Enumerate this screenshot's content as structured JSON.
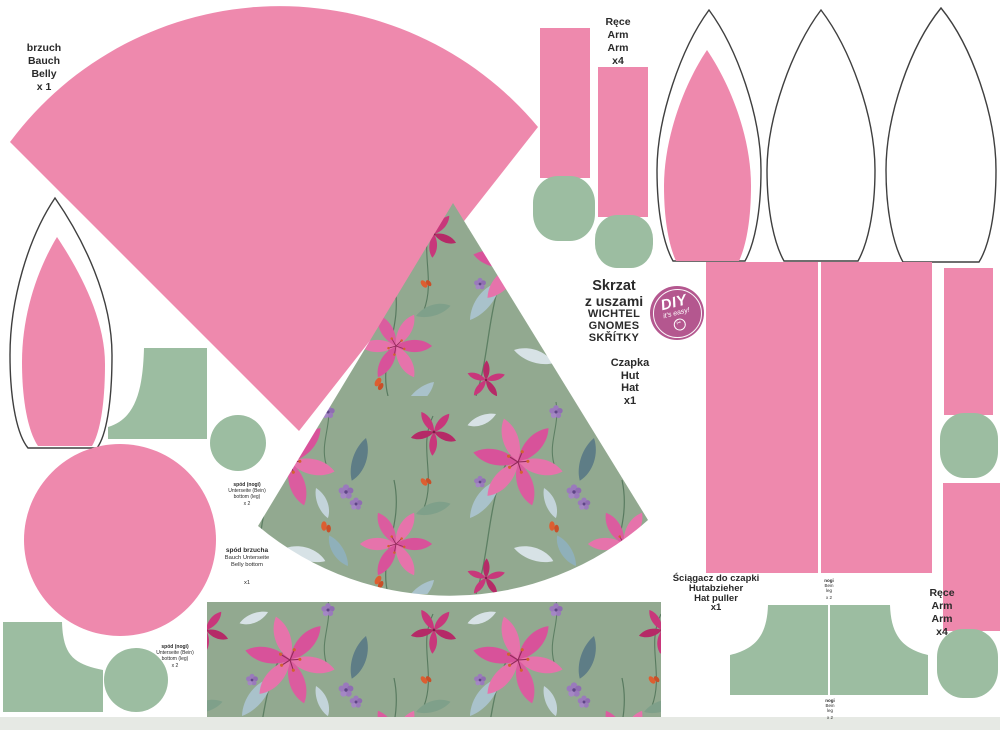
{
  "colors": {
    "pink": "#ee89ad",
    "sage": "#9cbda1",
    "fabric": "#92a990",
    "badge": "#b4578f",
    "outline": "#3f3f3f",
    "text": "#2a2a2a",
    "band": "#e6e9e4"
  },
  "badge": {
    "title": "DIY",
    "subtitle": "it's easy!",
    "icon": "scissors"
  },
  "labels": {
    "belly": [
      "brzuch",
      "Bauch",
      "Belly",
      "x 1"
    ],
    "arms_top": [
      "Ręce",
      "Arm",
      "Arm",
      "x4"
    ],
    "title": [
      "Skrzat",
      "z uszami",
      "WICHTEL",
      "GNOMES",
      "SKŘÍTKY"
    ],
    "hat": [
      "Czapka",
      "Hut",
      "Hat",
      "x1"
    ],
    "leg_bottom_small_1": [
      "spód (nogi)",
      "Unterseite (Bein)",
      "bottom (leg)",
      "x 2"
    ],
    "belly_bottom": [
      "spód brzucha",
      "Bauch Unterseite",
      "Belly bottom",
      "x1"
    ],
    "leg_bottom_small_2": [
      "spód (nogi)",
      "Unterseite (Bein)",
      "bottom (leg)",
      "x 2"
    ],
    "hat_puller": [
      "Ściągacz do czapki",
      "Hutabzieher",
      "Hat puller",
      "x1"
    ],
    "arms_right": [
      "Ręce",
      "Arm",
      "Arm",
      "x4"
    ],
    "legs_top": [
      "nogi",
      "Bein",
      "leg",
      "x 2"
    ],
    "legs_bottom": [
      "nogi",
      "Bein",
      "leg",
      "x 2"
    ]
  }
}
